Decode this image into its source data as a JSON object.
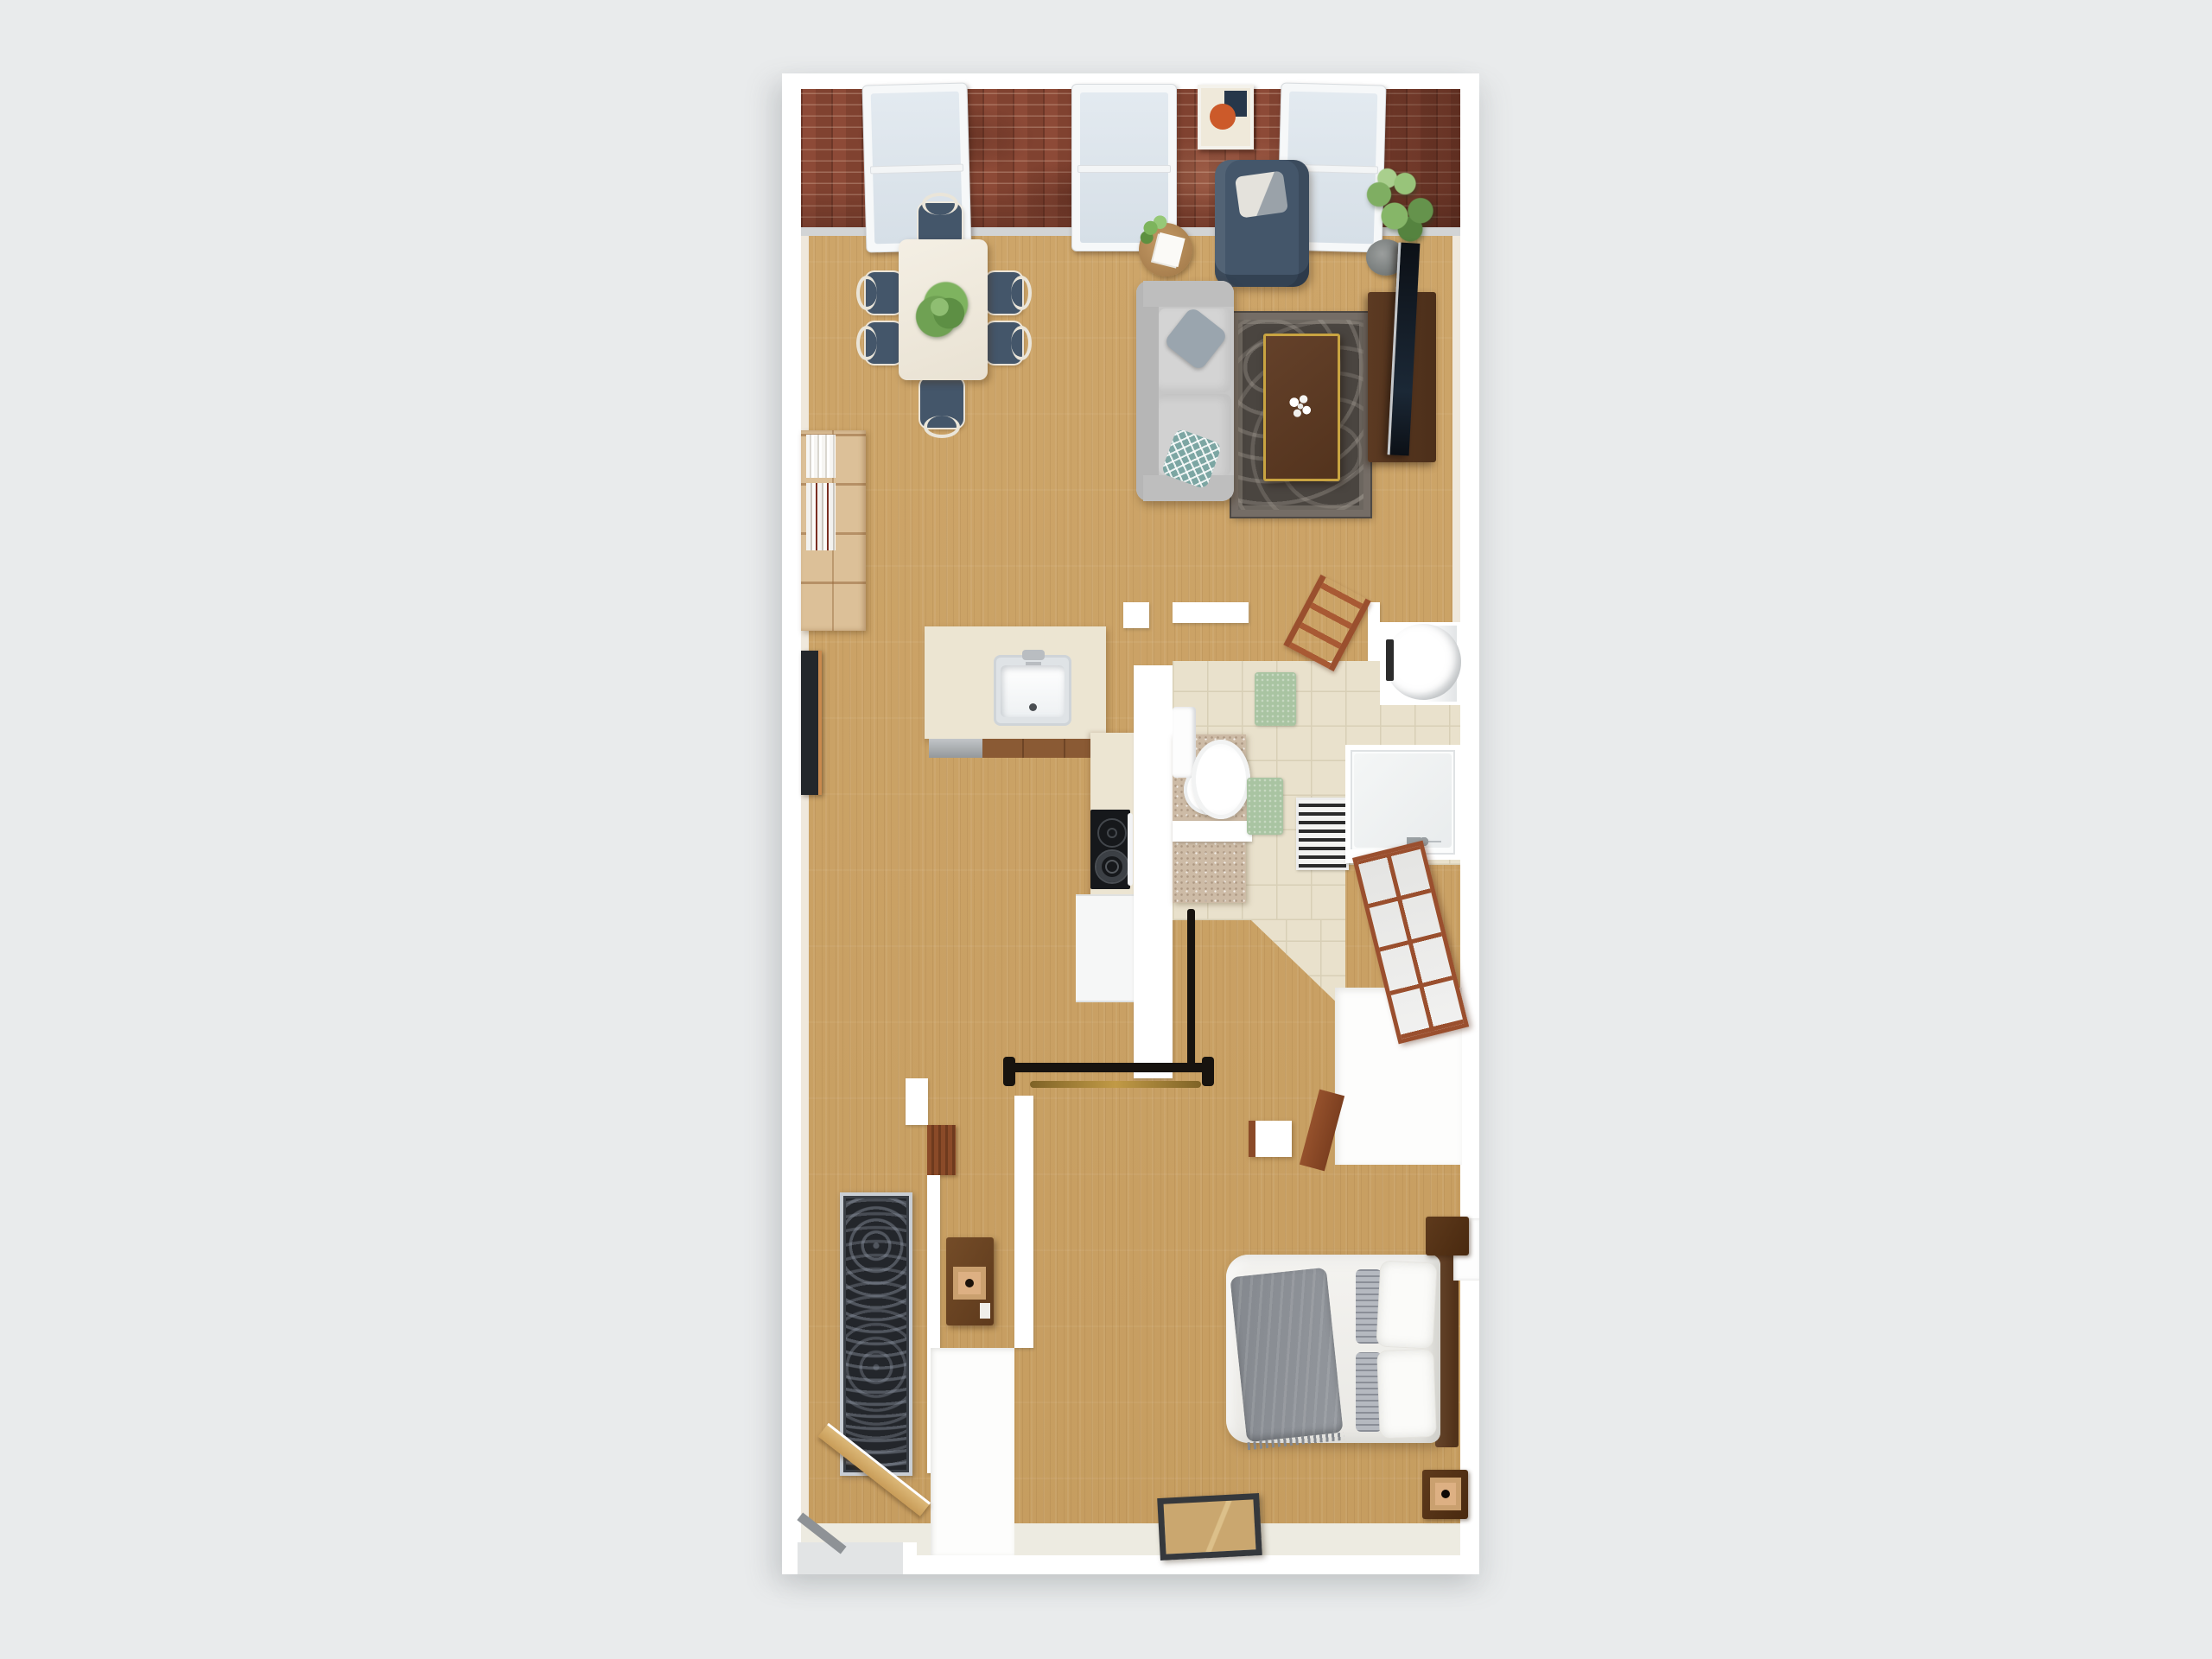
{
  "scene": {
    "kind": "3d-floorplan-top-down-render",
    "description": "Top-down 3D rendered floor plan of a one-bedroom apartment on a light gray background. Open living/dining room with brick accent wall and three windows at top, kitchen with island and peninsula counter in the middle, bathroom with shower, vanity, toilet and water-heater closet at middle right, hallway with coat rack and runner rug, and bedroom with queen bed at the bottom.",
    "rooms": [
      "living-room",
      "dining-area",
      "kitchen",
      "bathroom",
      "hallway",
      "bedroom",
      "closet"
    ]
  },
  "palette": {
    "bg": "#e9ebec",
    "wall": "#ffffff",
    "wallface": "#efe8dc",
    "wood": "#cda569",
    "wood2": "#c69d60",
    "brick": "#8d4a37",
    "tile": "#e9e1cc",
    "tileline": "#d8cfb6",
    "counter": "#ece5d2",
    "cabinet": "#8a5a34",
    "slate": "#44566a",
    "sofa": "#c7c7c7",
    "teal": "#7ca6a3",
    "rug": "#4a4540",
    "gold": "#c9a441",
    "mat": "#a9c4a2",
    "vanity": "#cdbba6",
    "organizer": "#9a4f2e",
    "runner": "#23262b",
    "door": "#dcb878",
    "shelfwood": "#dcc098",
    "lampshade": "#ddb083",
    "accentorange": "#cc5a2a"
  },
  "labels": {
    "plan": "Apartment floor plan (3D top view)",
    "brick": "Brick accent wall",
    "window": "Window",
    "artBrick": "Framed abstract art",
    "diningTable": "Dining table with plant centerpiece",
    "chair": "Dining chair",
    "bookshelf": "Bookshelf with books",
    "artLeaning": "Dark wall art",
    "armchair": "Blue armchair with pillow",
    "plant": "Potted plant",
    "sideTable": "Round side table with fern",
    "sofa": "Gray sofa with pillows",
    "rug": "Oriental area rug",
    "coffeeTable": "Walnut coffee table with flowers",
    "tvConsole": "TV console",
    "tv": "Flat-screen TV",
    "island": "Kitchen island with sink",
    "counterRun": "Kitchen counter run",
    "stove": "Cooktop",
    "appliance": "Kitchen appliance front",
    "tileFloor": "Bathroom tile floor",
    "vanity": "Bathroom vanity with vessel sink",
    "toilet": "Toilet",
    "mat": "Bath mat",
    "stripedRug": "Striped bath rug",
    "shower": "Walk-in shower",
    "heater": "Water heater",
    "ladder": "Ladder shelf",
    "organizer": "Closet organizer shelving",
    "neCloset": "Closet (white interior)",
    "coatRack": "Coat rack with brass rail",
    "dresser": "Hall console with lamp",
    "slatTable": "Slatted side table",
    "runner": "Hallway runner rug",
    "entryDoor": "Entry door (open)",
    "entryCloset": "Entry closet",
    "bed": "Queen bed with gray throw",
    "headboard": "Wood headboard",
    "pillow": "Pillow",
    "nightstand": "Nightstand",
    "lamp": "Table lamp",
    "mirror": "Floor mirror",
    "niche": "Wall niche",
    "wallSegment": "Wall segment",
    "windowCount": "3",
    "diningChairCount": "6"
  }
}
